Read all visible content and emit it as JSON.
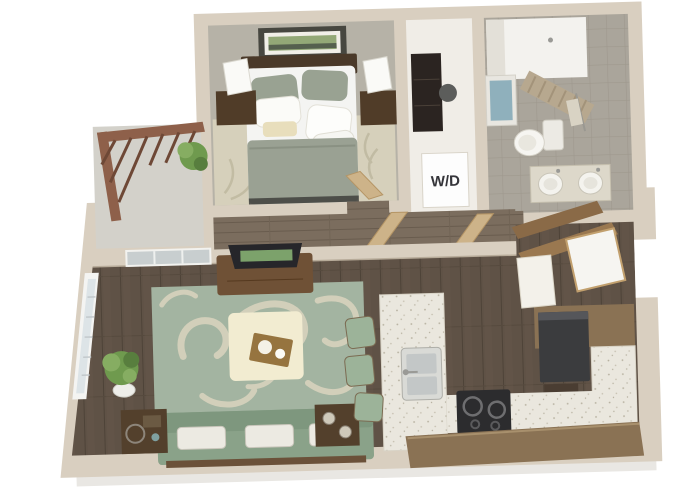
{
  "meta": {
    "kind": "3d-floor-plan-render",
    "subject": "one-bedroom apartment"
  },
  "labels": {
    "washer_dryer": "W/D"
  },
  "colors": {
    "background": "#ffffff",
    "wall": "#d9cfc0",
    "wall_shadow": "#c7baa8",
    "bedroom_carpet": "#b6b2a7",
    "bedroom_rug": "#d6d0bb",
    "bath_tile_base": "#aaa59b",
    "wood_floor": "#5f5246",
    "hallway_floor": "#7b6d5e",
    "rug_green": "#a3b4a1",
    "rug_pattern": "#d8d3bd",
    "sofa_green": "#8aa289",
    "ottoman_cream": "#f2ecd1",
    "tray_brown": "#96743f",
    "counter_white": "#eae7de",
    "cabinet_brown": "#8a7254",
    "fridge_dark": "#3b3c3e",
    "cooktop_black": "#2c2c2e",
    "bed_blanket": "#9aa193",
    "bed_sheets": "#f4f4f2",
    "headboard_brown": "#4a3929",
    "nightstand_brown": "#503c28",
    "door_wood": "#cdb389",
    "railing_wood": "#8e604a",
    "plant_green": "#6f9a4e",
    "tub_water": "#8fb0bc",
    "curtain_tan": "#b7a88f",
    "stool_green": "#9cb399",
    "tv_console_brown": "#6f5136",
    "balcony_floor": "#d3d1ca"
  },
  "rooms": {
    "bedroom": {
      "items": [
        "bed",
        "headboard",
        "pillows",
        "blanket",
        "area-rug",
        "nightstand-left",
        "lamp-left",
        "nightstand-right",
        "lamp-right",
        "wall-art"
      ]
    },
    "closet": {
      "items": [
        "wardrobe",
        "washer-dryer-closet"
      ]
    },
    "bathroom": {
      "items": [
        "shower",
        "shower-curtain",
        "bathtub",
        "toilet",
        "towel-bar",
        "vanity-double-sink"
      ]
    },
    "hallway": {
      "items": [
        "bedroom-door",
        "bathroom-door"
      ]
    },
    "living_room": {
      "items": [
        "tv",
        "media-console",
        "area-rug",
        "ottoman",
        "serving-tray",
        "sofa",
        "throw-pillows",
        "side-table-left",
        "side-table-right",
        "potted-plant",
        "window",
        "sliding-glass-door"
      ]
    },
    "kitchen": {
      "items": [
        "island",
        "sink",
        "bar-stools",
        "cooktop",
        "counters",
        "cabinets",
        "refrigerator"
      ]
    },
    "entry": {
      "items": [
        "front-door",
        "desk",
        "wall-shelves"
      ]
    },
    "balcony": {
      "items": [
        "railing",
        "planter"
      ]
    }
  }
}
